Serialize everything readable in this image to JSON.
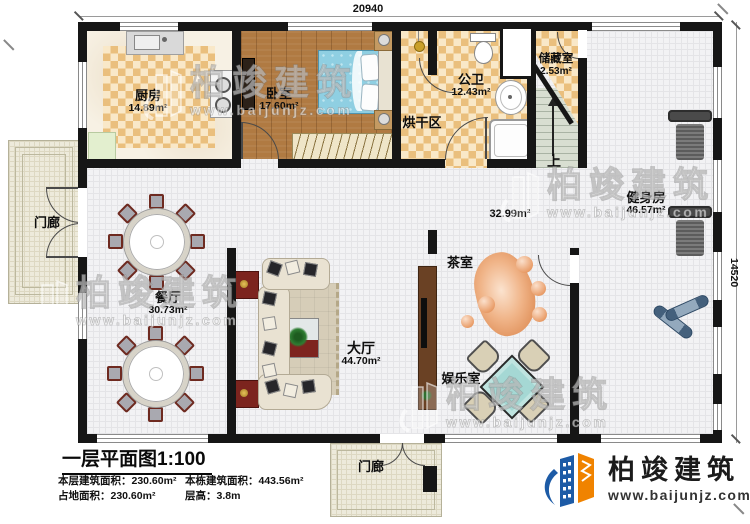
{
  "plan": {
    "dim_width": "20940",
    "dim_height": "14520"
  },
  "rooms": {
    "kitchen": {
      "name": "厨房",
      "area": "14.89m²"
    },
    "bedroom": {
      "name": "卧室",
      "area": "17.60m²"
    },
    "bath": {
      "name": "公卫",
      "area": "12.43m²"
    },
    "storage": {
      "name": "储藏室",
      "area": "2.53m²"
    },
    "drying": {
      "name": "烘干区"
    },
    "gym": {
      "name": "健身房",
      "area": "46.57m²"
    },
    "foyer": {
      "area": "32.99m²"
    },
    "dining": {
      "name": "餐厅",
      "area": "30.73m²"
    },
    "hall": {
      "name": "大厅",
      "area": "44.70m²"
    },
    "tearoom": {
      "name": "茶室"
    },
    "gameroom": {
      "name": "娱乐室"
    },
    "porch_left": {
      "name": "门廊"
    },
    "porch_bottom": {
      "name": "门廊"
    },
    "stairs_up": "上"
  },
  "title_block": {
    "title": "一层平面图1:100",
    "rows": [
      {
        "label": "本层建筑面积：",
        "value": "230.60m²"
      },
      {
        "label": "本栋建筑面积：",
        "value": "443.56m²"
      },
      {
        "label": "占地面积：",
        "value": "230.60m²"
      },
      {
        "label": "层高：",
        "value": "3.8m"
      }
    ]
  },
  "brand": {
    "name": "柏竣建筑",
    "website": "www.baijunjz.com"
  },
  "watermark": {
    "name": "柏竣建筑",
    "website": "www.baijunjz.com"
  },
  "colors": {
    "wall": "#161616",
    "checker_dark": "#eabf7d",
    "checker_light": "#f9e8c8",
    "wood": "#b07a42",
    "brand_blue": "#1d5ba6",
    "brand_orange": "#f08300",
    "bed_blue": "#8fcfe2",
    "table_teal": "#a5d8d4",
    "stair_green": "#d8ded1"
  }
}
